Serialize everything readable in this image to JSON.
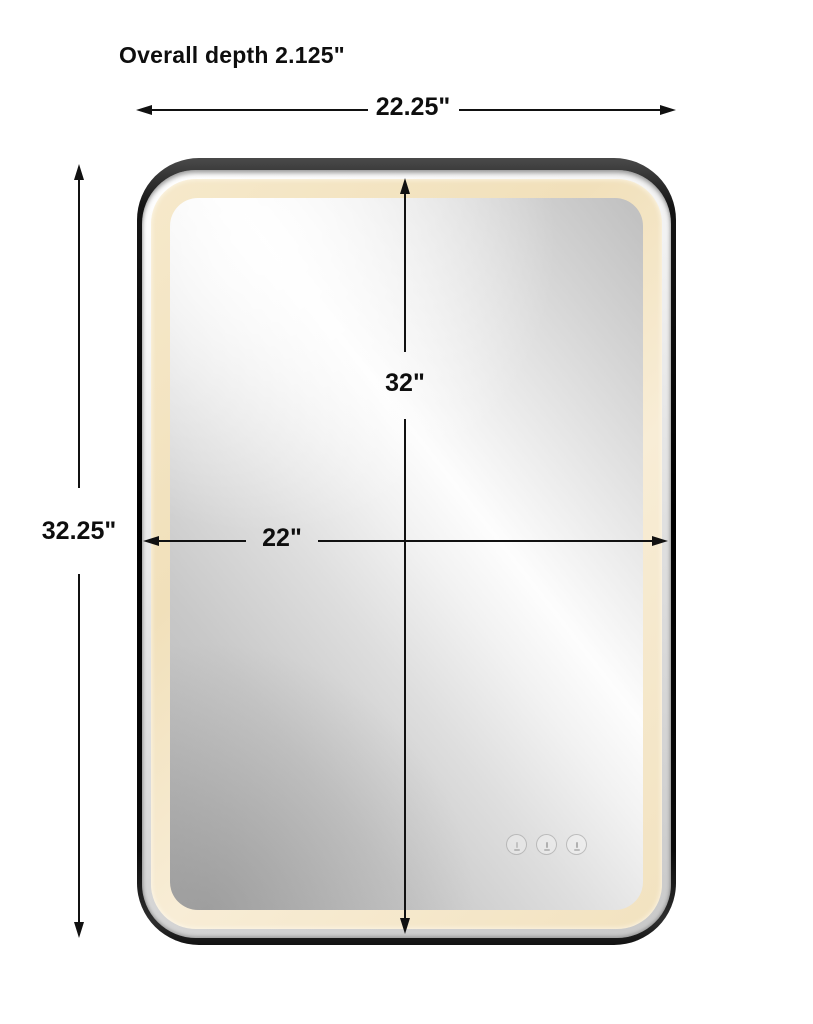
{
  "page": {
    "background": "#ffffff"
  },
  "annotations": {
    "overall_depth_label": "Overall depth 2.125\"",
    "arrow_color": "#111111",
    "dimensions": [
      {
        "id": "overall-width",
        "label": "22.25\"",
        "orientation": "horizontal"
      },
      {
        "id": "overall-height",
        "label": "32.25\"",
        "orientation": "vertical"
      },
      {
        "id": "inner-height",
        "label": "32\"",
        "orientation": "vertical"
      },
      {
        "id": "inner-width",
        "label": "22\"",
        "orientation": "horizontal"
      }
    ]
  },
  "product": {
    "type": "rounded-rectangle LED vanity mirror",
    "frame_color": "#141414",
    "led_halo_color": "#f4e5c3",
    "touch_controls": {
      "count": 3,
      "icons": [
        "power-icon",
        "brightness-icon",
        "light-temperature-icon"
      ]
    }
  }
}
